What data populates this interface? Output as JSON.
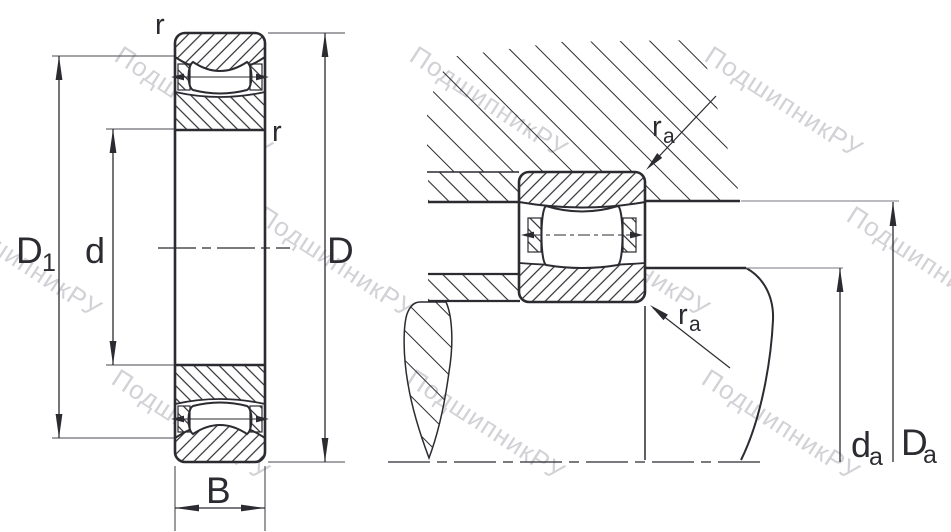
{
  "watermark": {
    "text": "ПодшипникРУ",
    "color": "#c6c6cc"
  },
  "colors": {
    "line": "#2b2b31",
    "background": "#ffffff"
  },
  "left_view": {
    "labels": {
      "shoulder_diameter": {
        "base": "D",
        "sub": "1"
      },
      "bore_diameter": "d",
      "outer_diameter": "D",
      "width": "B",
      "corner_radius_top": "r",
      "corner_radius_inner": "r"
    }
  },
  "right_view": {
    "labels": {
      "fillet_radius_top": {
        "base": "r",
        "sub": "a"
      },
      "fillet_radius_bottom": {
        "base": "r",
        "sub": "a"
      },
      "shaft_abutment_diameter": {
        "base": "d",
        "sub": "a"
      },
      "housing_abutment_diameter": {
        "base": "D",
        "sub": "a"
      }
    }
  }
}
